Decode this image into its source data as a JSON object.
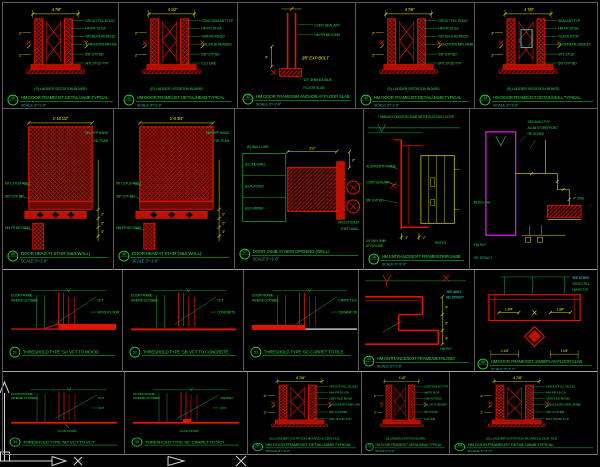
{
  "app": {
    "name": "CAD drawing viewport",
    "view": "door and threshold details sheet"
  },
  "colors": {
    "background": "#000000",
    "linework_red": "#e01400",
    "annotation_green": "#1fd641",
    "dimension_yellow": "#e8e800",
    "scale_cyan": "#2ab7a6",
    "highlight_cyan": "#36e0e0",
    "storefront_magenta": "#e018e0",
    "ucs_white": "#d8d8d8",
    "grid_gray": "#5f5f5f"
  },
  "icons": {
    "ucs": "AutoCAD UCS axis icon (X/Y arrows at lower-left of model space)"
  },
  "ucs": {
    "x_label": "X"
  },
  "cells": [
    {
      "id": "r1c1",
      "bubble": "40",
      "dims": [
        "4 7/8\"",
        "2\"",
        "2\""
      ],
      "labels": [
        "GROUT FILL SOLID",
        "HM FR 16 GA",
        "WD BLKG AS REQD",
        "3 ANCHORS MIN JAMB",
        "5/8\" GYP BD",
        "MTL STUD TYP"
      ],
      "caption": "(S) LADDER S/STATION BOARD",
      "title": "HM DOOR FRAME/JST DETAIL/JAMB TYPICAL",
      "scale": "SCALE 3\"=1'-0\""
    },
    {
      "id": "r1c2",
      "bubble": "41",
      "dims": [
        "4 1/2\"",
        "2\"",
        "2\""
      ],
      "labels": [
        "CONT SEALANT TYP",
        "HM FR 16 GA",
        "SHIM AS REQD",
        "DBL STUD HEADER",
        "5/8\" GYP BD",
        "CLG LINE"
      ],
      "caption": "(E) LADDER S/STATION BOARD",
      "title": "HM DOOR FRAME/JST DETAIL/HEAD TYPICAL",
      "scale": "SCALE 3\"=1'-0\""
    },
    {
      "id": "r1c3",
      "bubble": "42",
      "dims": [
        "4\""
      ],
      "labels": [
        "CONT SEALANT",
        "HM FR BEYOND",
        "1/2\" SHIM EA SIDE",
        "FLOOR SLAB"
      ],
      "note": "3/8\" EXP BOLT",
      "title": "HM DOOR FRAME/SIM ANCHOR AT FLOOR SLAB",
      "scale": "SCALE 3\"=1'-0\""
    },
    {
      "id": "r1c4",
      "bubble": "43",
      "dims": [
        "4 7/8\"",
        "2\"",
        "2\""
      ],
      "labels": [
        "GROUT FILL SOLID",
        "HM FR 16 GA",
        "WD BLKG AS REQD",
        "5 ANCHORS MIN JAMB",
        "5/8\" GYP BD",
        "MTL STUD TYP"
      ],
      "caption": "(S) LADDER S/STATION BOARD",
      "title": "HM DOOR FRAME/JST DETAIL/JAMB TYPICAL",
      "scale": "SCALE 3\"=1'-0\""
    },
    {
      "id": "r1c5",
      "bubble": "44",
      "dims": [
        "4 7/8\"",
        "2\"",
        "2\""
      ],
      "labels": [
        "SEALANT TYP",
        "HM FR 16 GA",
        "GLASS STOP",
        "NEOPRENE GASKET",
        "MTL STUD",
        "5/8\" GYP BD"
      ],
      "caption": "(S) LADDER S/STATION BOARD",
      "title": "HM DOOR FRAME/JST DETAIL/MULL TYPICAL",
      "scale": "SCALE 3\"=1'-0\""
    },
    {
      "id": "r2c1",
      "bubble": "45",
      "dims": [
        "1'-10 1/2\"",
        "2\"",
        "2\"",
        "4\""
      ],
      "labels": [
        "MTL STUD WALL",
        "5/8\" GYP BD",
        "HM FR BEYOND",
        "SIM OPP HAND",
        "RE: PLAN"
      ],
      "title": "DOOR HEAD AT STAIR (S&S WALL)",
      "scale": "SCALE 3\"=1'-0\""
    },
    {
      "id": "r2c2",
      "bubble": "46",
      "dims": [
        "1'-0 3/4\"",
        "2\"",
        "2\"",
        "4\""
      ],
      "labels": [
        "MTL STUD WALL",
        "5/8\" GYP BD",
        "HM FR BEYOND",
        "SIM OPP HAND",
        "RE: PLAN"
      ],
      "title": "DOOR HEAD AT STAIR (S&S WALL)",
      "scale": "SCALE 3\"=1'-0\""
    },
    {
      "id": "r2c3",
      "bubble": "47",
      "dims": [
        "2'-0\"",
        "6\""
      ],
      "labels": [
        "(E) WALL LINE",
        "(E) CMU WALL",
        "(E) PLASTER",
        "(E) FURRING",
        "GROUT SOLID",
        "EXIST WALL"
      ],
      "title": "DOOR JAMB AT NEW OPENING (WALL)",
      "scale": "SCALE 3\"=1'-0\""
    },
    {
      "id": "r2c4",
      "bubble": "48",
      "dims": [
        "2\"",
        "2\""
      ],
      "note": "* SIMILAR CONDITION SAME METHOD AT EXIST. DOOR",
      "labels": [
        "ALUM ENTR FRAME",
        "CONT SEALANT",
        "5/8\" GYP BD",
        "1/4\" MAX SHIM",
        "AT FLR LINE",
        "FIN FLR"
      ],
      "title": "HM ENTRANCE/EXIT FRAME/STRIP/JAMB",
      "scale": "SCALE 3\"=1'-0\""
    },
    {
      "id": "r2c5",
      "labels": [
        "SEE 4/A5.1 TYP",
        "ALUM STOREFRONT",
        "RE: SCHED",
        "BLDG LINE",
        "4\" CMU",
        "FIN FLR",
        "RE: STRUCT"
      ]
    },
    {
      "id": "r3c1",
      "bubble": "51",
      "labels": [
        "DOOR FRAME",
        "WHERE OCCURS",
        "VCT",
        "WOOD FLOOR"
      ],
      "title": "THRESHOLD TYPE 'SA' VCT TO WOOD"
    },
    {
      "id": "r3c2",
      "bubble": "52",
      "labels": [
        "DOOR FRAME",
        "WHERE OCCURS",
        "VCT",
        "CONCRETE"
      ],
      "title": "THRESHOLD TYPE 'SB' VCT TO CONCRETE"
    },
    {
      "id": "r3c3",
      "bubble": "53",
      "labels": [
        "DOOR FRAME",
        "WHERE OCCURS",
        "CARPET & PAD",
        "CERAMIC TILE"
      ],
      "title": "THRESHOLD TYPE 'SC' CARPET TO TILE"
    },
    {
      "id": "r3c4",
      "bubble": "49",
      "dims": [
        "4\"",
        "6\"",
        "4\""
      ],
      "labels": [
        "SEE 4/A5.1",
        "RE: STRUCT",
        "FIN FLR"
      ],
      "title": "HM ENTRANCE/EXIT FRAME/DETAIL/SIM",
      "scale": "SCALE 3\"=1'-0\""
    },
    {
      "id": "r3c5",
      "bubble": "50",
      "dims": [
        "1 3/4\"",
        "1 3/4\"",
        "1 1/4\"",
        "1 1/4\""
      ],
      "labels": [
        "SEE SCHED",
        "GROUT FILL",
        "HM FR TYP"
      ],
      "title": "HM DOOR FRAME/SET JAMB/PLAN FLOOR SLAB",
      "scale": "SCALE 3\"=1'-0\""
    },
    {
      "id": "r4c1",
      "bubble": "54",
      "labels": [
        "DOOR FRAME",
        "WHERE OCCURS",
        "VCT",
        "VCT"
      ],
      "center": "CL OF DOOR",
      "title": "THRESHOLD TYPE 'SD' VCT TO VCT"
    },
    {
      "id": "r4c2",
      "bubble": "55",
      "labels": [
        "DOOR FRAME",
        "WHERE OCCURS",
        "CARPET",
        "VCT"
      ],
      "center": "CL OF DOOR",
      "title": "THRESHOLD TYPE 'SE' CARPET TO VCT"
    },
    {
      "id": "r4c3",
      "bubble": "56",
      "dims": [
        "4 7/8\"",
        "2\"",
        "2\""
      ],
      "labels": [
        "GROUT FILL SOLID",
        "HM FR 16 GA",
        "CER TILE BASE",
        "3 ANCHORS MIN JAMB",
        "5/8\" GYP BD",
        "MTL STUD TYP"
      ],
      "caption": "(S) LADDER S/STATION BOARD & CER TILE",
      "title": "HM DOOR FRAME/JST DETAIL/JAMB TYPICAL",
      "scale": "SCALE 3\"=1'-0\""
    },
    {
      "id": "r4c4",
      "bubble": "57",
      "dims": [
        "4 1/2\"",
        "2\"",
        "2\""
      ],
      "labels": [
        "CONT SEALANT TYP",
        "HM FR 16 GA",
        "SHIM AS REQD",
        "DBL STUD HEADER",
        "5/8\" GYP BD",
        "CLG LINE"
      ],
      "caption": "(S) LADDER S/STATION BOARD",
      "title": "HM DOOR FRAME/JST DETAIL/HEAD TYPICAL",
      "scale": "SCALE 3\"=1'-0\""
    },
    {
      "id": "r4c5",
      "bubble": "58",
      "dims": [
        "4 7/8\"",
        "2\"",
        "2\""
      ],
      "labels": [
        "GROUT FILL SOLID",
        "HM FR 16 GA",
        "CER TILE BASE",
        "3 ANCHORS MIN JAMB",
        "5/8\" GYP BD",
        "MTL STUD TYP"
      ],
      "caption": "(S) LADDER S/STATION BOARD & CER TILE",
      "title": "HM DOOR FRAME/JST DETAIL/JAMB TYPICAL",
      "scale": "SCALE 3\"=1'-0\""
    }
  ]
}
